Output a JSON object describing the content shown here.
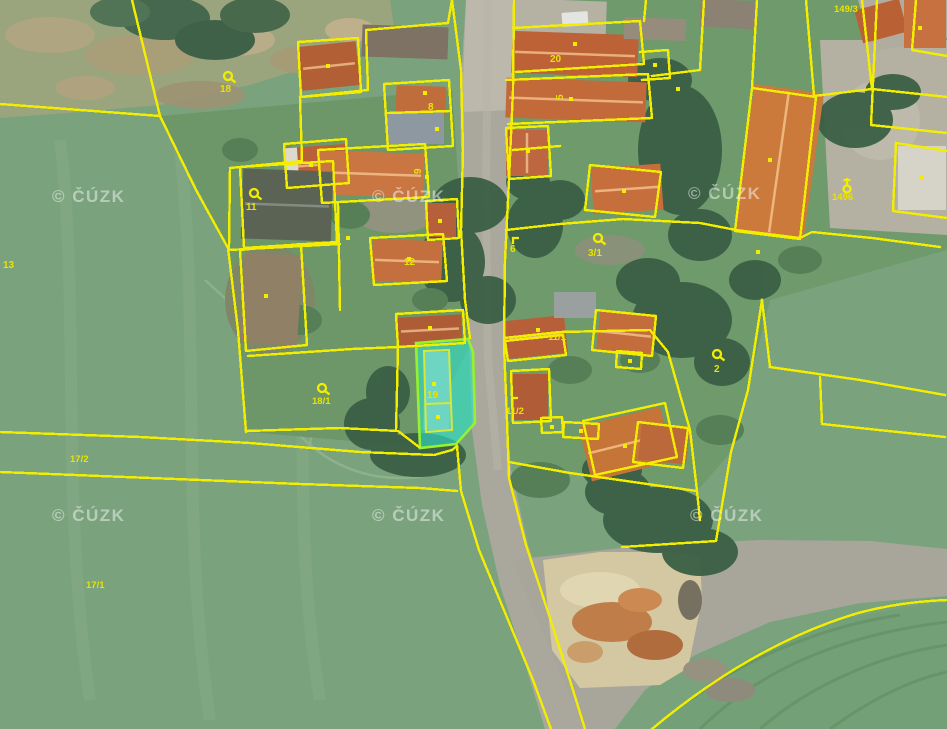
{
  "map": {
    "description": "Aerial cadastral map with parcel overlay",
    "watermark": {
      "text": "© ČÚZK"
    },
    "watermark_positions": [
      [
        52,
        202
      ],
      [
        372,
        202
      ],
      [
        688,
        199
      ],
      [
        52,
        521
      ],
      [
        372,
        521
      ],
      [
        690,
        521
      ]
    ],
    "highlighted_parcel": {
      "number": "19",
      "fill": "#2de0c8",
      "stroke": "#97f22e"
    },
    "colors": {
      "parcel_line": "#f3ee00",
      "parcel_label": "#e8e300",
      "field_green": "#7aa37d",
      "road_gray": "#aaa89d",
      "roof_orange": "#c4703e",
      "sand": "#d3c8a2"
    },
    "parcel_labels": [
      {
        "text": "13",
        "x": 3,
        "y": 268
      },
      {
        "text": "17/2",
        "x": 70,
        "y": 462
      },
      {
        "text": "17/1",
        "x": 86,
        "y": 588
      },
      {
        "text": "18",
        "x": 220,
        "y": 92,
        "symbol": "loop",
        "sx": 228,
        "sy": 76
      },
      {
        "text": "11",
        "x": 246,
        "y": 210,
        "symbol": "loop",
        "sx": 254,
        "sy": 193
      },
      {
        "text": "18/1",
        "x": 312,
        "y": 404,
        "symbol": "loop",
        "sx": 322,
        "sy": 388
      },
      {
        "text": "12",
        "x": 404,
        "y": 265
      },
      {
        "text": "8",
        "x": 428,
        "y": 110
      },
      {
        "text": "9",
        "x": 421,
        "y": 174,
        "rotate": -90
      },
      {
        "text": "20",
        "x": 550,
        "y": 62
      },
      {
        "text": "5",
        "x": 563,
        "y": 100,
        "rotate": -90
      },
      {
        "text": "6",
        "x": 510,
        "y": 252,
        "symbol": "corner",
        "sx": 513,
        "sy": 238
      },
      {
        "text": "3/1",
        "x": 588,
        "y": 256,
        "symbol": "loop",
        "sx": 598,
        "sy": 238
      },
      {
        "text": "11/1",
        "x": 548,
        "y": 340
      },
      {
        "text": "11/2",
        "x": 506,
        "y": 414,
        "symbol": "corner",
        "sx": 512,
        "sy": 398
      },
      {
        "text": "2",
        "x": 714,
        "y": 372,
        "symbol": "loop",
        "sx": 717,
        "sy": 354
      },
      {
        "text": "149/3",
        "x": 834,
        "y": 12
      },
      {
        "text": "1496",
        "x": 832,
        "y": 200,
        "symbol": "flag",
        "sx": 847,
        "sy": 186
      },
      {
        "text": "19",
        "x": 427,
        "y": 398,
        "symbol": "dot",
        "sx": 434,
        "sy": 384
      }
    ]
  }
}
